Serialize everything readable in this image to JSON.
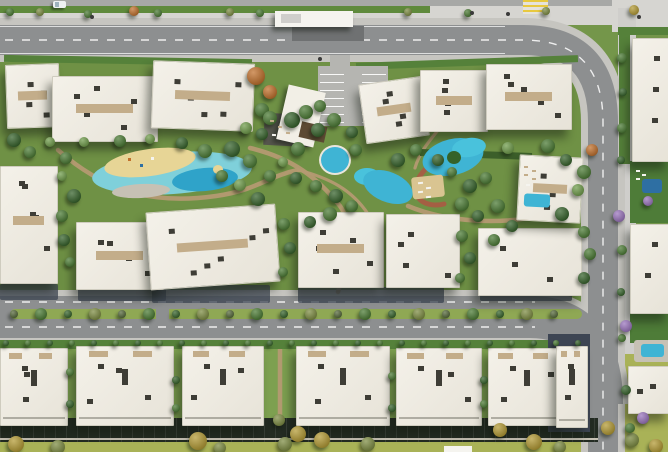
{
  "scene": {
    "width": 668,
    "height": 452,
    "description": "Aerial 3D rendering of a residential compound master plan: white apartment buildings around a landscaped central spine with lagoon pools, a clubhouse canopy, tree-lined boulevard with planted median, perimeter roads, rear townhouse rows with private gardens, and a large building block on the east side.",
    "palette": {
      "grass": "#74964a",
      "grass_dark": "#5f8a3c",
      "grass_mid": "#6f9145",
      "grass_mid2": "#7da050",
      "grass_light": "#8fae62",
      "lawn": "#a9b257",
      "road": "#8d8f90",
      "road_top": "#a7a8a6",
      "casing": "#c6c5c0",
      "asphalt_dark": "#6f7172",
      "sidewalk": "#d6d5d1",
      "sidewalk2": "#cfcecb",
      "building": "#f2efe6",
      "building_edge": "#cfccbf",
      "vent": "#3e3d36",
      "deck_tan": "#c3ad8a",
      "pergola": "#5d4a33",
      "deck_dark": "#56564d",
      "deck_pale": "#c6c1b4",
      "court_dark": "#31312b",
      "court_dark2": "#55506b",
      "court_green": "#4e7c38",
      "pool": "#3fb4d4",
      "pool2": "#49c2dc",
      "pool_light": "#7fd0da",
      "pool_mid": "#2fa3c9",
      "pool_deep": "#2e6fa3",
      "sand": "#e7d596",
      "sand2": "#d9c491",
      "hedge": "#55813a",
      "hedge_dark": "#3c5f2a",
      "median": "#8fa854",
      "navy": "#3d4553",
      "backyard": "#232b22",
      "path": "#b49a72",
      "track": "#a45f43",
      "crosswalk_y": "#e8c93f",
      "crosswalk_w": "#e6e3da",
      "white": "#f5f4ef",
      "car": "#eef0f2",
      "cyclist": "#3a3a3a",
      "t_green": "#4a7a33",
      "t_dark": "#35622a",
      "t_light": "#6f9c4a",
      "t_olive": "#7d8c42",
      "t_yellow": "#b39a33",
      "t_orange": "#c1702b",
      "t_purple": "#9a74bd",
      "t_median": "#55683a"
    }
  },
  "strips": [
    [
      0,
      0,
      668,
      7,
      "road_top"
    ],
    [
      0,
      6,
      430,
      8,
      "grass_dark"
    ],
    [
      430,
      6,
      238,
      8,
      "sidewalk"
    ],
    [
      0,
      13,
      668,
      12,
      "sidewalk"
    ],
    [
      612,
      0,
      56,
      32,
      "sidewalk"
    ],
    [
      618,
      8,
      18,
      444,
      "sidewalk2"
    ],
    [
      0,
      55,
      590,
      241,
      "grass_mid"
    ],
    [
      0,
      338,
      600,
      92,
      "grass_mid2"
    ],
    [
      0,
      430,
      616,
      22,
      "lawn"
    ],
    [
      616,
      354,
      52,
      98,
      "lawn"
    ]
  ],
  "greens": [
    [
      4,
      57,
      248,
      7,
      1,
      "hedge"
    ],
    [
      356,
      59,
      222,
      7,
      -2,
      "hedge"
    ],
    [
      420,
      151,
      112,
      7,
      2,
      "hedge_dark"
    ],
    [
      0,
      340,
      586,
      9,
      0,
      "hedge"
    ],
    [
      618,
      27,
      50,
      8,
      0,
      "hedge"
    ],
    [
      619,
      30,
      11,
      134,
      0,
      "hedge"
    ],
    [
      630,
      161,
      38,
      62,
      0,
      "court_green"
    ],
    [
      630,
      313,
      38,
      30,
      0,
      "court_green"
    ]
  ],
  "shadows": [
    [
      0,
      284,
      58,
      16
    ],
    [
      78,
      288,
      88,
      13
    ],
    [
      152,
      285,
      118,
      18
    ],
    [
      298,
      287,
      146,
      16
    ],
    [
      480,
      289,
      92,
      12
    ]
  ],
  "structures": [
    [
      0,
      418,
      598,
      24,
      0,
      "backyard",
      "fence"
    ],
    [
      0,
      438,
      598,
      2,
      0,
      "deck_pale",
      ""
    ],
    [
      548,
      334,
      42,
      98,
      0,
      "navy",
      ""
    ],
    [
      292,
      26,
      72,
      15,
      0,
      "asphalt_dark",
      ""
    ],
    [
      318,
      66,
      70,
      60,
      0,
      "",
      "park"
    ],
    [
      275,
      11,
      78,
      16,
      0,
      "white",
      "sh"
    ],
    [
      281,
      14,
      20,
      9,
      0,
      "sidewalk2",
      ""
    ],
    [
      523,
      0,
      25,
      14,
      0,
      "",
      "xwalk"
    ],
    [
      264,
      114,
      48,
      32,
      3,
      "deck_dark",
      ""
    ],
    [
      282,
      88,
      38,
      56,
      13,
      "building",
      "sh"
    ],
    [
      300,
      124,
      26,
      16,
      13,
      "pergola",
      ""
    ],
    [
      524,
      241,
      42,
      43,
      13,
      "court_dark",
      "b"
    ],
    [
      650,
      66,
      18,
      52,
      0,
      "court_dark2",
      ""
    ],
    [
      651,
      120,
      17,
      36,
      0,
      "court_dark2",
      ""
    ],
    [
      659,
      236,
      9,
      72,
      0,
      "court_dark2",
      ""
    ],
    [
      632,
      226,
      34,
      6,
      0,
      "hedge",
      ""
    ],
    [
      444,
      446,
      28,
      6,
      0,
      "white",
      ""
    ]
  ],
  "buildings": {
    "top": [
      [
        6,
        64,
        52,
        62,
        -2,
        4,
        "d"
      ],
      [
        52,
        76,
        104,
        64,
        0,
        5,
        "d"
      ],
      [
        152,
        62,
        100,
        66,
        2,
        5,
        "d"
      ],
      [
        362,
        80,
        62,
        58,
        -8,
        4,
        "d"
      ],
      [
        420,
        70,
        66,
        60,
        0,
        4,
        "d"
      ],
      [
        486,
        64,
        84,
        64,
        0,
        5,
        "d"
      ]
    ],
    "middle": [
      [
        0,
        166,
        56,
        116,
        0,
        5,
        "d"
      ],
      [
        76,
        222,
        86,
        66,
        0,
        4,
        "d"
      ],
      [
        148,
        208,
        128,
        76,
        -4,
        6,
        "d"
      ],
      [
        298,
        212,
        84,
        74,
        0,
        5,
        "d"
      ],
      [
        386,
        214,
        72,
        72,
        0,
        4,
        ""
      ],
      [
        478,
        228,
        102,
        66,
        0,
        3,
        ""
      ],
      [
        518,
        156,
        62,
        64,
        3,
        3,
        "d"
      ]
    ],
    "bottom": [
      [
        0,
        348,
        66,
        76,
        0,
        3,
        "u"
      ],
      [
        76,
        346,
        96,
        78,
        0,
        4,
        "u"
      ],
      [
        182,
        346,
        80,
        78,
        0,
        3,
        "u"
      ],
      [
        296,
        346,
        92,
        78,
        0,
        4,
        "u"
      ],
      [
        396,
        348,
        84,
        76,
        0,
        3,
        "u"
      ],
      [
        488,
        348,
        76,
        76,
        0,
        3,
        "u"
      ],
      [
        556,
        346,
        30,
        80,
        0,
        2,
        "u"
      ]
    ],
    "right": [
      [
        632,
        38,
        36,
        122,
        0,
        3,
        ""
      ],
      [
        630,
        224,
        38,
        88,
        0,
        2,
        ""
      ],
      [
        628,
        366,
        40,
        46,
        0,
        2,
        ""
      ]
    ]
  },
  "pools": [
    [
      92,
      152,
      160,
      42,
      -4,
      "pool_light",
      "e"
    ],
    [
      104,
      149,
      92,
      27,
      -8,
      "sand",
      "e"
    ],
    [
      172,
      168,
      66,
      23,
      -5,
      "pool_mid",
      "e"
    ],
    [
      213,
      165,
      10,
      9,
      0,
      "sand",
      "e"
    ],
    [
      112,
      184,
      58,
      14,
      -3,
      "deck_pale",
      "e"
    ],
    [
      319,
      145,
      28,
      26,
      0,
      "pool",
      "ring"
    ],
    [
      354,
      168,
      26,
      17,
      0,
      "pool2",
      "e"
    ],
    [
      362,
      172,
      52,
      30,
      22,
      "pool",
      "e"
    ],
    [
      422,
      139,
      62,
      36,
      -14,
      "pool",
      "e"
    ],
    [
      452,
      138,
      34,
      19,
      -8,
      "pool2",
      "e"
    ],
    [
      447,
      151,
      14,
      13,
      0,
      "t_dark",
      "e"
    ],
    [
      412,
      176,
      32,
      22,
      -6,
      "sand2",
      "r"
    ],
    [
      634,
      340,
      36,
      22,
      0,
      "deck_pale",
      "r"
    ],
    [
      641,
      344,
      23,
      13,
      0,
      "pool",
      "r"
    ],
    [
      524,
      194,
      26,
      13,
      3,
      "pool",
      "r"
    ],
    [
      642,
      179,
      20,
      14,
      0,
      "pool_deep",
      "r"
    ]
  ],
  "trees": {
    "amenity": [
      [
        14,
        140,
        7,
        "dark"
      ],
      [
        30,
        152,
        6,
        "green"
      ],
      [
        50,
        142,
        5,
        "light"
      ],
      [
        66,
        158,
        6,
        "green"
      ],
      [
        74,
        196,
        7,
        "dark"
      ],
      [
        62,
        216,
        6,
        "green"
      ],
      [
        62,
        176,
        5,
        "light"
      ],
      [
        64,
        240,
        6,
        "dark"
      ],
      [
        70,
        262,
        5,
        "green"
      ],
      [
        84,
        142,
        5,
        "light"
      ],
      [
        120,
        141,
        6,
        "green"
      ],
      [
        150,
        139,
        5,
        "light"
      ],
      [
        182,
        143,
        6,
        "dark"
      ],
      [
        205,
        151,
        7,
        "green"
      ],
      [
        232,
        149,
        8,
        "dark"
      ],
      [
        250,
        161,
        7,
        "green"
      ],
      [
        240,
        185,
        6,
        "light"
      ],
      [
        222,
        176,
        6,
        "green"
      ],
      [
        258,
        199,
        7,
        "dark"
      ],
      [
        270,
        176,
        6,
        "green"
      ],
      [
        283,
        162,
        5,
        "light"
      ],
      [
        298,
        149,
        7,
        "green"
      ],
      [
        296,
        178,
        6,
        "dark"
      ],
      [
        316,
        186,
        6,
        "green"
      ],
      [
        336,
        196,
        7,
        "dark"
      ],
      [
        352,
        206,
        6,
        "green"
      ],
      [
        330,
        214,
        7,
        "green"
      ],
      [
        310,
        222,
        6,
        "dark"
      ],
      [
        284,
        224,
        6,
        "green"
      ],
      [
        290,
        248,
        6,
        "dark"
      ],
      [
        283,
        272,
        5,
        "green"
      ],
      [
        356,
        150,
        6,
        "green"
      ],
      [
        398,
        160,
        7,
        "dark"
      ],
      [
        416,
        150,
        6,
        "green"
      ],
      [
        438,
        160,
        6,
        "dark"
      ],
      [
        452,
        172,
        5,
        "green"
      ],
      [
        470,
        186,
        7,
        "dark"
      ],
      [
        486,
        178,
        6,
        "green"
      ],
      [
        462,
        204,
        7,
        "green"
      ],
      [
        478,
        216,
        6,
        "dark"
      ],
      [
        498,
        206,
        7,
        "green"
      ],
      [
        512,
        226,
        6,
        "dark"
      ],
      [
        494,
        240,
        6,
        "green"
      ],
      [
        462,
        236,
        6,
        "green"
      ],
      [
        470,
        258,
        6,
        "dark"
      ],
      [
        460,
        278,
        5,
        "green"
      ],
      [
        508,
        148,
        6,
        "light"
      ],
      [
        548,
        146,
        7,
        "green"
      ],
      [
        566,
        160,
        6,
        "dark"
      ],
      [
        584,
        172,
        7,
        "green"
      ],
      [
        578,
        190,
        6,
        "light"
      ],
      [
        562,
        214,
        7,
        "dark"
      ],
      [
        584,
        232,
        6,
        "green"
      ],
      [
        590,
        254,
        6,
        "green"
      ],
      [
        584,
        278,
        6,
        "dark"
      ],
      [
        262,
        110,
        7,
        "green"
      ],
      [
        246,
        128,
        6,
        "light"
      ],
      [
        292,
        120,
        8,
        "dark"
      ],
      [
        306,
        112,
        7,
        "green"
      ],
      [
        318,
        130,
        7,
        "dark"
      ],
      [
        270,
        118,
        7,
        "green"
      ],
      [
        262,
        134,
        6,
        "dark"
      ],
      [
        320,
        106,
        6,
        "green"
      ],
      [
        334,
        120,
        7,
        "green"
      ],
      [
        352,
        132,
        6,
        "dark"
      ],
      [
        256,
        76,
        9,
        "orange"
      ],
      [
        270,
        92,
        7,
        "orange"
      ],
      [
        592,
        150,
        6,
        "orange"
      ]
    ],
    "gaps": [
      [
        70,
        372,
        4,
        "green"
      ],
      [
        70,
        404,
        4,
        "dark"
      ],
      [
        176,
        380,
        4,
        "dark"
      ],
      [
        176,
        408,
        4,
        "green"
      ],
      [
        392,
        376,
        4,
        "green"
      ],
      [
        392,
        408,
        4,
        "dark"
      ],
      [
        484,
        380,
        4,
        "dark"
      ],
      [
        484,
        404,
        4,
        "green"
      ],
      [
        279,
        420,
        6,
        "olive"
      ],
      [
        298,
        434,
        8,
        "yellow"
      ],
      [
        285,
        444,
        7,
        "olive"
      ]
    ],
    "lawn": [
      [
        16,
        444,
        8,
        "yellow"
      ],
      [
        58,
        447,
        7,
        "olive"
      ],
      [
        198,
        441,
        9,
        "yellow"
      ],
      [
        220,
        448,
        6,
        "olive"
      ],
      [
        322,
        440,
        8,
        "yellow"
      ],
      [
        368,
        444,
        7,
        "olive"
      ],
      [
        500,
        430,
        7,
        "yellow"
      ],
      [
        534,
        442,
        8,
        "yellow"
      ],
      [
        560,
        447,
        6,
        "olive"
      ],
      [
        608,
        428,
        7,
        "yellow"
      ],
      [
        632,
        440,
        7,
        "olive"
      ],
      [
        656,
        446,
        7,
        "yellow"
      ]
    ],
    "top_strip": [
      [
        10,
        12,
        4,
        "green"
      ],
      [
        40,
        12,
        4,
        "olive"
      ],
      [
        88,
        14,
        4,
        "green"
      ],
      [
        134,
        11,
        5,
        "orange"
      ],
      [
        158,
        13,
        4,
        "green"
      ],
      [
        230,
        12,
        4,
        "olive"
      ],
      [
        260,
        13,
        4,
        "green"
      ],
      [
        408,
        12,
        4,
        "olive"
      ],
      [
        468,
        13,
        4,
        "green"
      ],
      [
        546,
        11,
        4,
        "olive"
      ],
      [
        634,
        10,
        5,
        "yellow"
      ]
    ],
    "right_col": [
      [
        622,
        58,
        5,
        "green"
      ],
      [
        623,
        92,
        4,
        "dark"
      ],
      [
        622,
        128,
        5,
        "green"
      ],
      [
        621,
        160,
        4,
        "dark"
      ],
      [
        622,
        250,
        5,
        "green"
      ],
      [
        621,
        292,
        4,
        "dark"
      ],
      [
        622,
        338,
        4,
        "green"
      ],
      [
        626,
        390,
        5,
        "dark"
      ],
      [
        630,
        428,
        5,
        "green"
      ]
    ],
    "purple": [
      [
        619,
        216,
        6,
        "purple"
      ],
      [
        648,
        201,
        5,
        "purple"
      ],
      [
        626,
        326,
        6,
        "purple"
      ],
      [
        643,
        418,
        6,
        "purple"
      ]
    ],
    "median_row": {
      "y": 314,
      "x0": 14,
      "x1": 576,
      "step": 27,
      "radii": [
        4,
        6
      ],
      "colors": [
        "median",
        "green",
        "dark",
        "olive"
      ]
    },
    "hedge_row": {
      "y": 343,
      "x0": 6,
      "x1": 580,
      "step": 22,
      "radii": [
        3,
        3
      ],
      "colors": [
        "dark",
        "green"
      ]
    }
  },
  "dots": [
    [
      418,
      182,
      5,
      2,
      "white",
      -6
    ],
    [
      426,
      187,
      5,
      2,
      "white",
      -6
    ],
    [
      418,
      191,
      5,
      2,
      "white",
      -6
    ],
    [
      426,
      196,
      5,
      2,
      "white",
      -6
    ],
    [
      524,
      166,
      4,
      2,
      "deck_tan",
      0
    ],
    [
      532,
      170,
      4,
      2,
      "deck_tan",
      0
    ],
    [
      524,
      174,
      4,
      2,
      "deck_tan",
      0
    ],
    [
      532,
      178,
      4,
      2,
      "deck_tan",
      0
    ],
    [
      526,
      184,
      4,
      2,
      "white",
      0
    ],
    [
      636,
      170,
      4,
      2,
      "white",
      0
    ],
    [
      642,
      174,
      4,
      2,
      "white",
      0
    ],
    [
      636,
      178,
      4,
      2,
      "white",
      0
    ],
    [
      270,
      120,
      4,
      2,
      "deck_tan",
      3
    ],
    [
      278,
      126,
      4,
      2,
      "deck_tan",
      3
    ],
    [
      286,
      132,
      4,
      2,
      "deck_tan",
      3
    ],
    [
      272,
      134,
      4,
      2,
      "white",
      3
    ],
    [
      128,
      158,
      3,
      3,
      "t_orange",
      0
    ],
    [
      140,
      164,
      3,
      3,
      "pool_deep",
      0
    ],
    [
      151,
      157,
      3,
      3,
      "white",
      0
    ]
  ],
  "vehicles": {
    "car": [
      53,
      1,
      13,
      7
    ],
    "cyclists": [
      [
        90,
        15
      ],
      [
        470,
        11
      ],
      [
        506,
        12
      ],
      [
        318,
        57
      ],
      [
        637,
        15
      ]
    ]
  }
}
